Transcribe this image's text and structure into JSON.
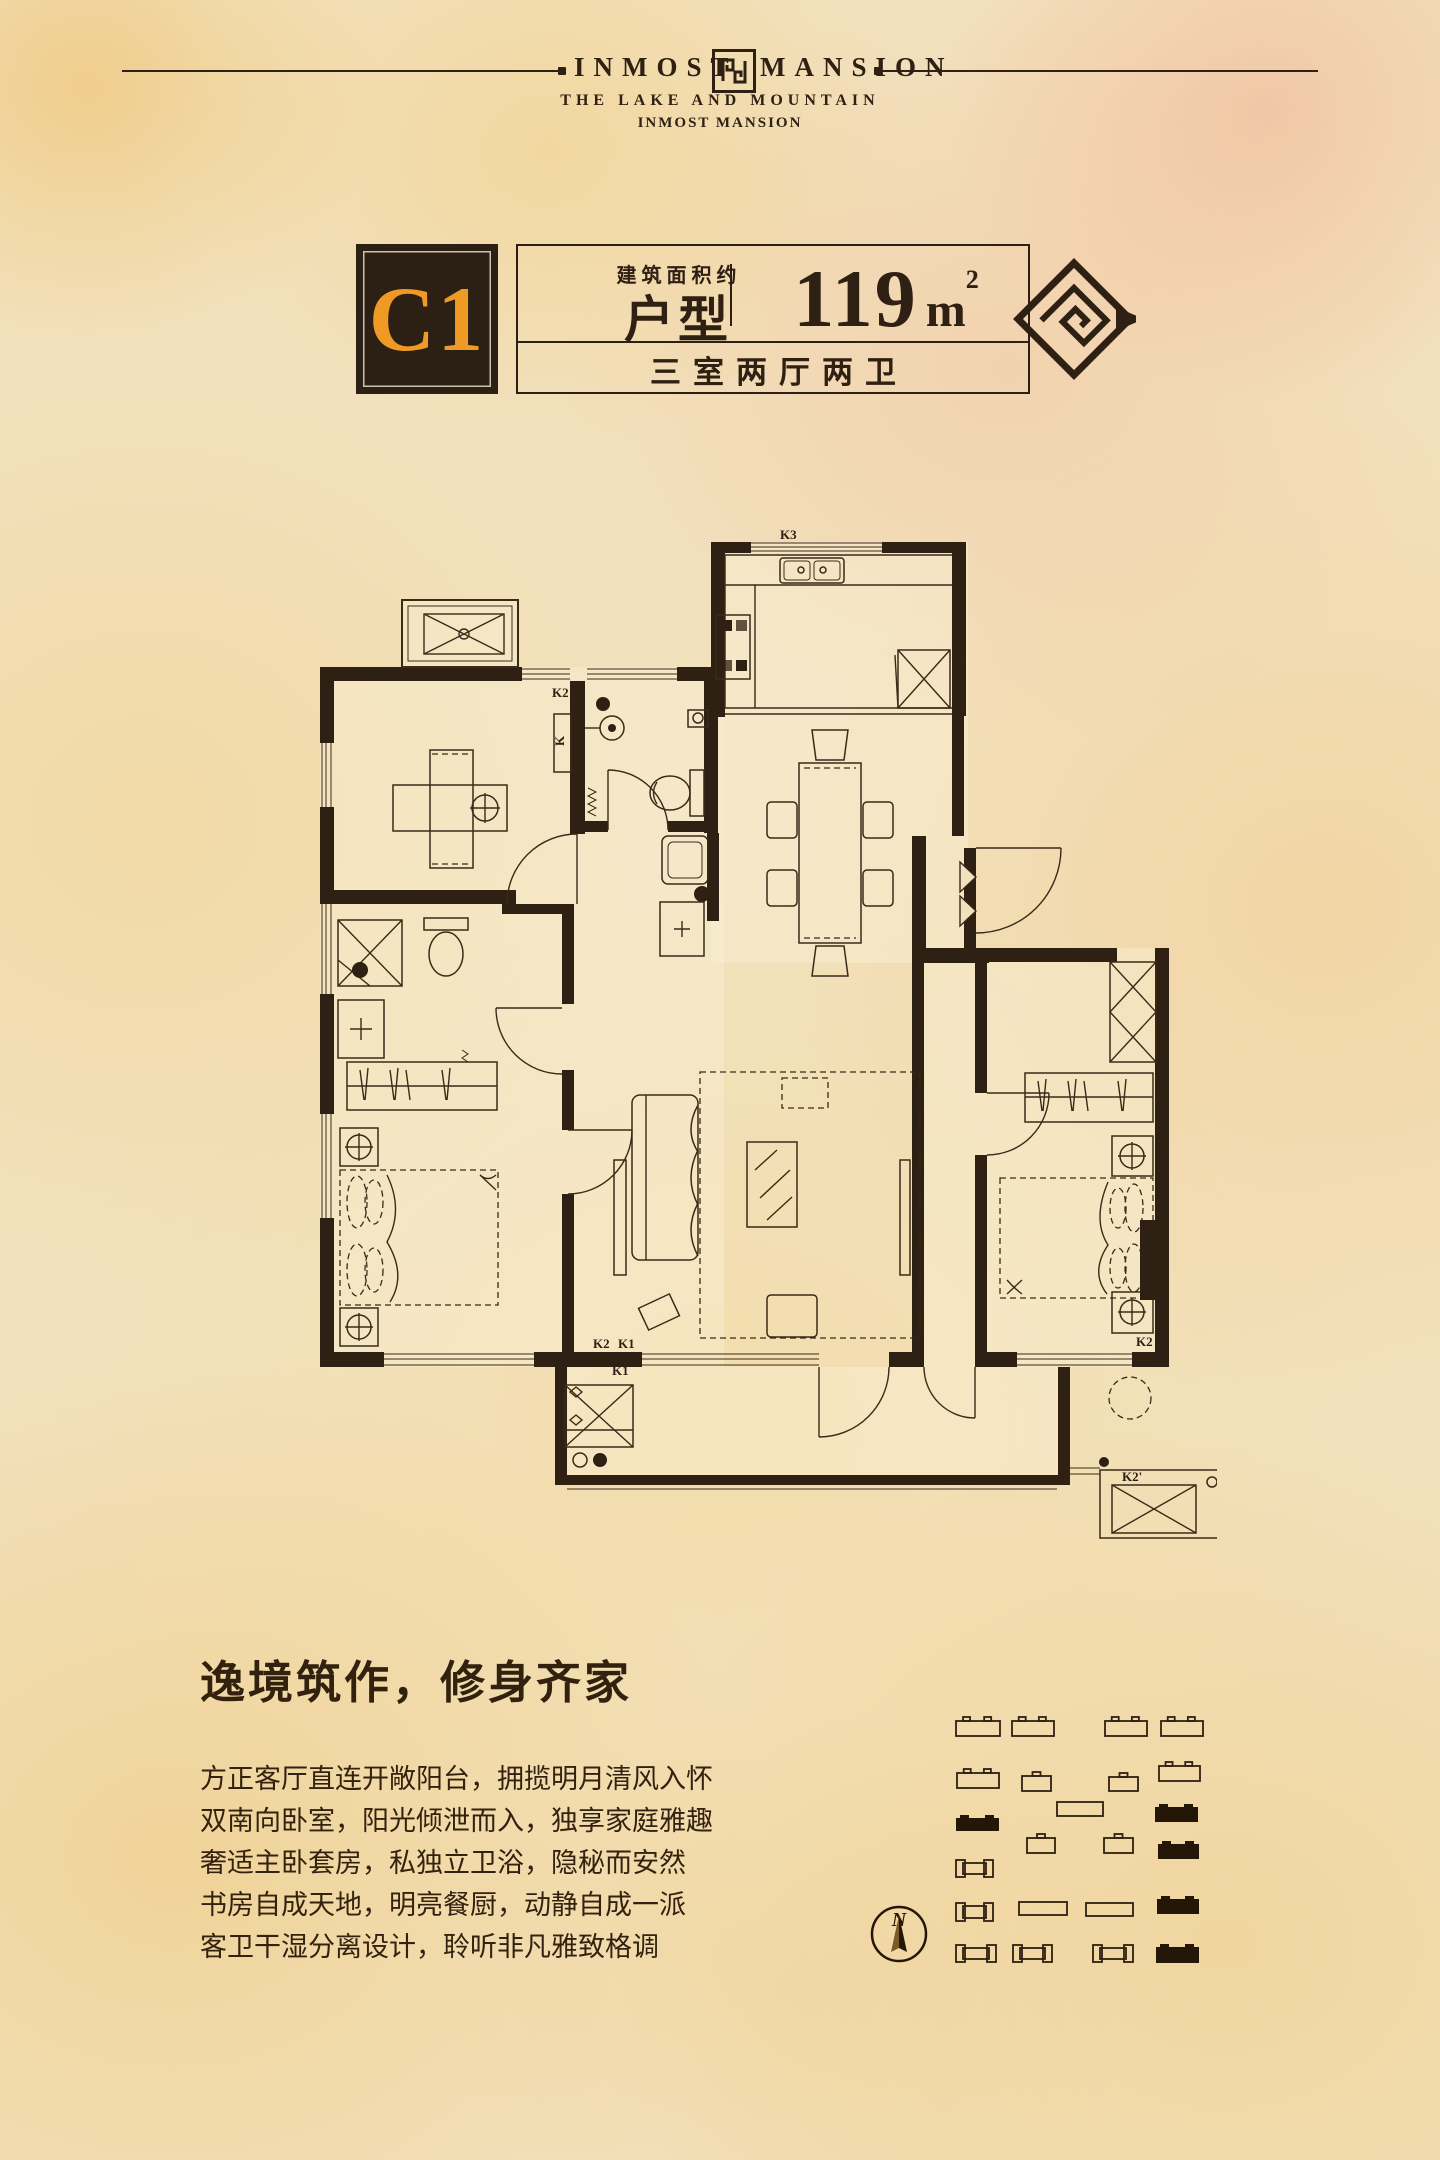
{
  "colors": {
    "ink": "#2e2012",
    "orange": "#f09a26",
    "paper": "#f2e1bd",
    "line": "#3a2a18"
  },
  "header": {
    "brand_left": "INMOST",
    "brand_right": "MANSION",
    "subtitle1": "THE LAKE AND MOUNTAIN",
    "subtitle2": "INMOST MANSION"
  },
  "unit": {
    "code": "C1",
    "area_label": "建筑面积约",
    "type_label": "户型",
    "area_value": "119",
    "area_unit_base": "m",
    "area_unit_sup": "2",
    "rooms_label": "三室两厅两卫"
  },
  "floorplan": {
    "labels": [
      {
        "t": "K3",
        "x": 468,
        "y": 9
      },
      {
        "t": "K2",
        "x": 240,
        "y": 167
      },
      {
        "t": "K",
        "x": 252,
        "y": 216,
        "rot": true
      },
      {
        "t": "K2",
        "x": 281,
        "y": 818
      },
      {
        "t": "K1",
        "x": 306,
        "y": 818
      },
      {
        "t": "K1",
        "x": 300,
        "y": 845
      },
      {
        "t": "K2",
        "x": 824,
        "y": 816
      },
      {
        "t": "K2'",
        "x": 810,
        "y": 951
      }
    ]
  },
  "description": {
    "heading": "逸境筑作，修身齐家",
    "lines": [
      "方正客厅直连开敞阳台，拥揽明月清风入怀",
      "双南向卧室，阳光倾泄而入，独享家庭雅趣",
      "奢适主卧套房，私独立卫浴，隐秘而安然",
      "书房自成天地，明亮餐厨，动静自成一派",
      "客卫干湿分离设计，聆听非凡雅致格调"
    ]
  },
  "siteplan": {
    "compass": "N",
    "buildings": [
      {
        "type": "o",
        "x": 126,
        "y": 61,
        "w": 44,
        "h": 15
      },
      {
        "type": "o",
        "x": 182,
        "y": 61,
        "w": 42,
        "h": 15
      },
      {
        "type": "o",
        "x": 275,
        "y": 61,
        "w": 42,
        "h": 15
      },
      {
        "type": "o",
        "x": 331,
        "y": 61,
        "w": 42,
        "h": 15
      },
      {
        "type": "o",
        "x": 127,
        "y": 113,
        "w": 42,
        "h": 15
      },
      {
        "type": "s",
        "x": 192,
        "y": 116,
        "w": 29,
        "h": 15
      },
      {
        "type": "s",
        "x": 279,
        "y": 117,
        "w": 29,
        "h": 14
      },
      {
        "type": "o",
        "x": 329,
        "y": 106,
        "w": 41,
        "h": 15
      },
      {
        "type": "p",
        "x": 227,
        "y": 142,
        "w": 46,
        "h": 14
      },
      {
        "type": "f",
        "x": 325,
        "y": 147,
        "w": 43,
        "h": 15
      },
      {
        "type": "f",
        "x": 126,
        "y": 158,
        "w": 43,
        "h": 13
      },
      {
        "type": "s",
        "x": 197,
        "y": 178,
        "w": 28,
        "h": 15
      },
      {
        "type": "s",
        "x": 274,
        "y": 178,
        "w": 29,
        "h": 15
      },
      {
        "type": "f",
        "x": 328,
        "y": 184,
        "w": 41,
        "h": 15
      },
      {
        "type": "h",
        "x": 126,
        "y": 200,
        "w": 37,
        "h": 17
      },
      {
        "type": "h",
        "x": 126,
        "y": 243,
        "w": 37,
        "h": 18
      },
      {
        "type": "p",
        "x": 189,
        "y": 242,
        "w": 48,
        "h": 13
      },
      {
        "type": "p",
        "x": 256,
        "y": 243,
        "w": 47,
        "h": 13
      },
      {
        "type": "f",
        "x": 327,
        "y": 239,
        "w": 42,
        "h": 15
      },
      {
        "type": "h",
        "x": 126,
        "y": 285,
        "w": 40,
        "h": 17
      },
      {
        "type": "h",
        "x": 183,
        "y": 285,
        "w": 39,
        "h": 17
      },
      {
        "type": "h",
        "x": 263,
        "y": 285,
        "w": 40,
        "h": 17
      },
      {
        "type": "f",
        "x": 326,
        "y": 287,
        "w": 43,
        "h": 16
      }
    ]
  }
}
